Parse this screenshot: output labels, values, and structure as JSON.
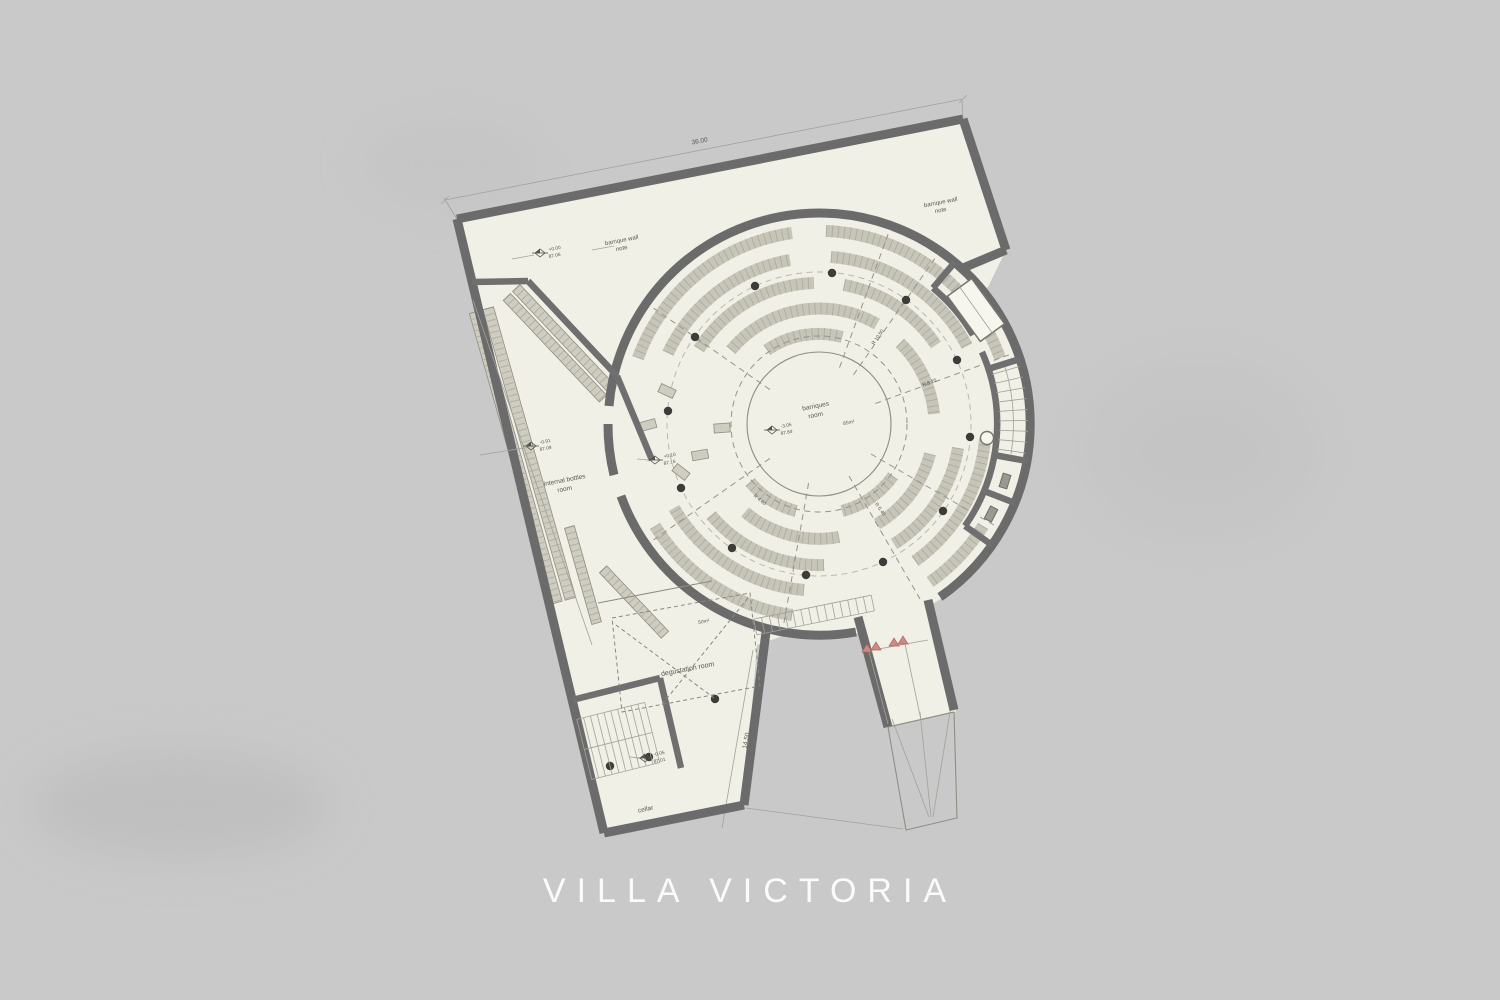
{
  "title": "VILLA VICTORIA",
  "colors": {
    "background": "#c9c9c9",
    "paper": "#f1f0e7",
    "wall": "#6b6b6b",
    "rack": "#c7c5b8",
    "ink": "#5a5850",
    "accent_red": "#c05f5b",
    "title_text": "#fbfbfb"
  },
  "plan": {
    "notes": {
      "top_left": {
        "line1": "barrique wall",
        "line2": "note"
      },
      "top_right": {
        "line1": "barrique wall",
        "line2": "note"
      }
    },
    "rooms": {
      "barriques": {
        "line1": "barriques",
        "line2": "room",
        "area": "85m²"
      },
      "internal_bottles": {
        "line1": "internal bottles",
        "line2": "room"
      },
      "degustation": {
        "label": "degustation room",
        "area": "50m²"
      },
      "cellar": {
        "label": "cellar"
      }
    },
    "levels": {
      "m1": {
        "rel": "+0.00",
        "abs": "87.06"
      },
      "m2": {
        "rel": "-0.91",
        "abs": "87.09"
      },
      "m3": {
        "rel": "+0.10",
        "abs": "87.16"
      },
      "m4": {
        "rel": "-3.05",
        "abs": "87.84"
      },
      "m5": {
        "rel": "-0.05",
        "abs": "87.01"
      }
    },
    "dimensions": {
      "top": "36.00",
      "side": "14.50"
    },
    "radial_dims": [
      "R 10.50",
      "R 8.20",
      "R 6.40",
      "R 4.60"
    ]
  }
}
